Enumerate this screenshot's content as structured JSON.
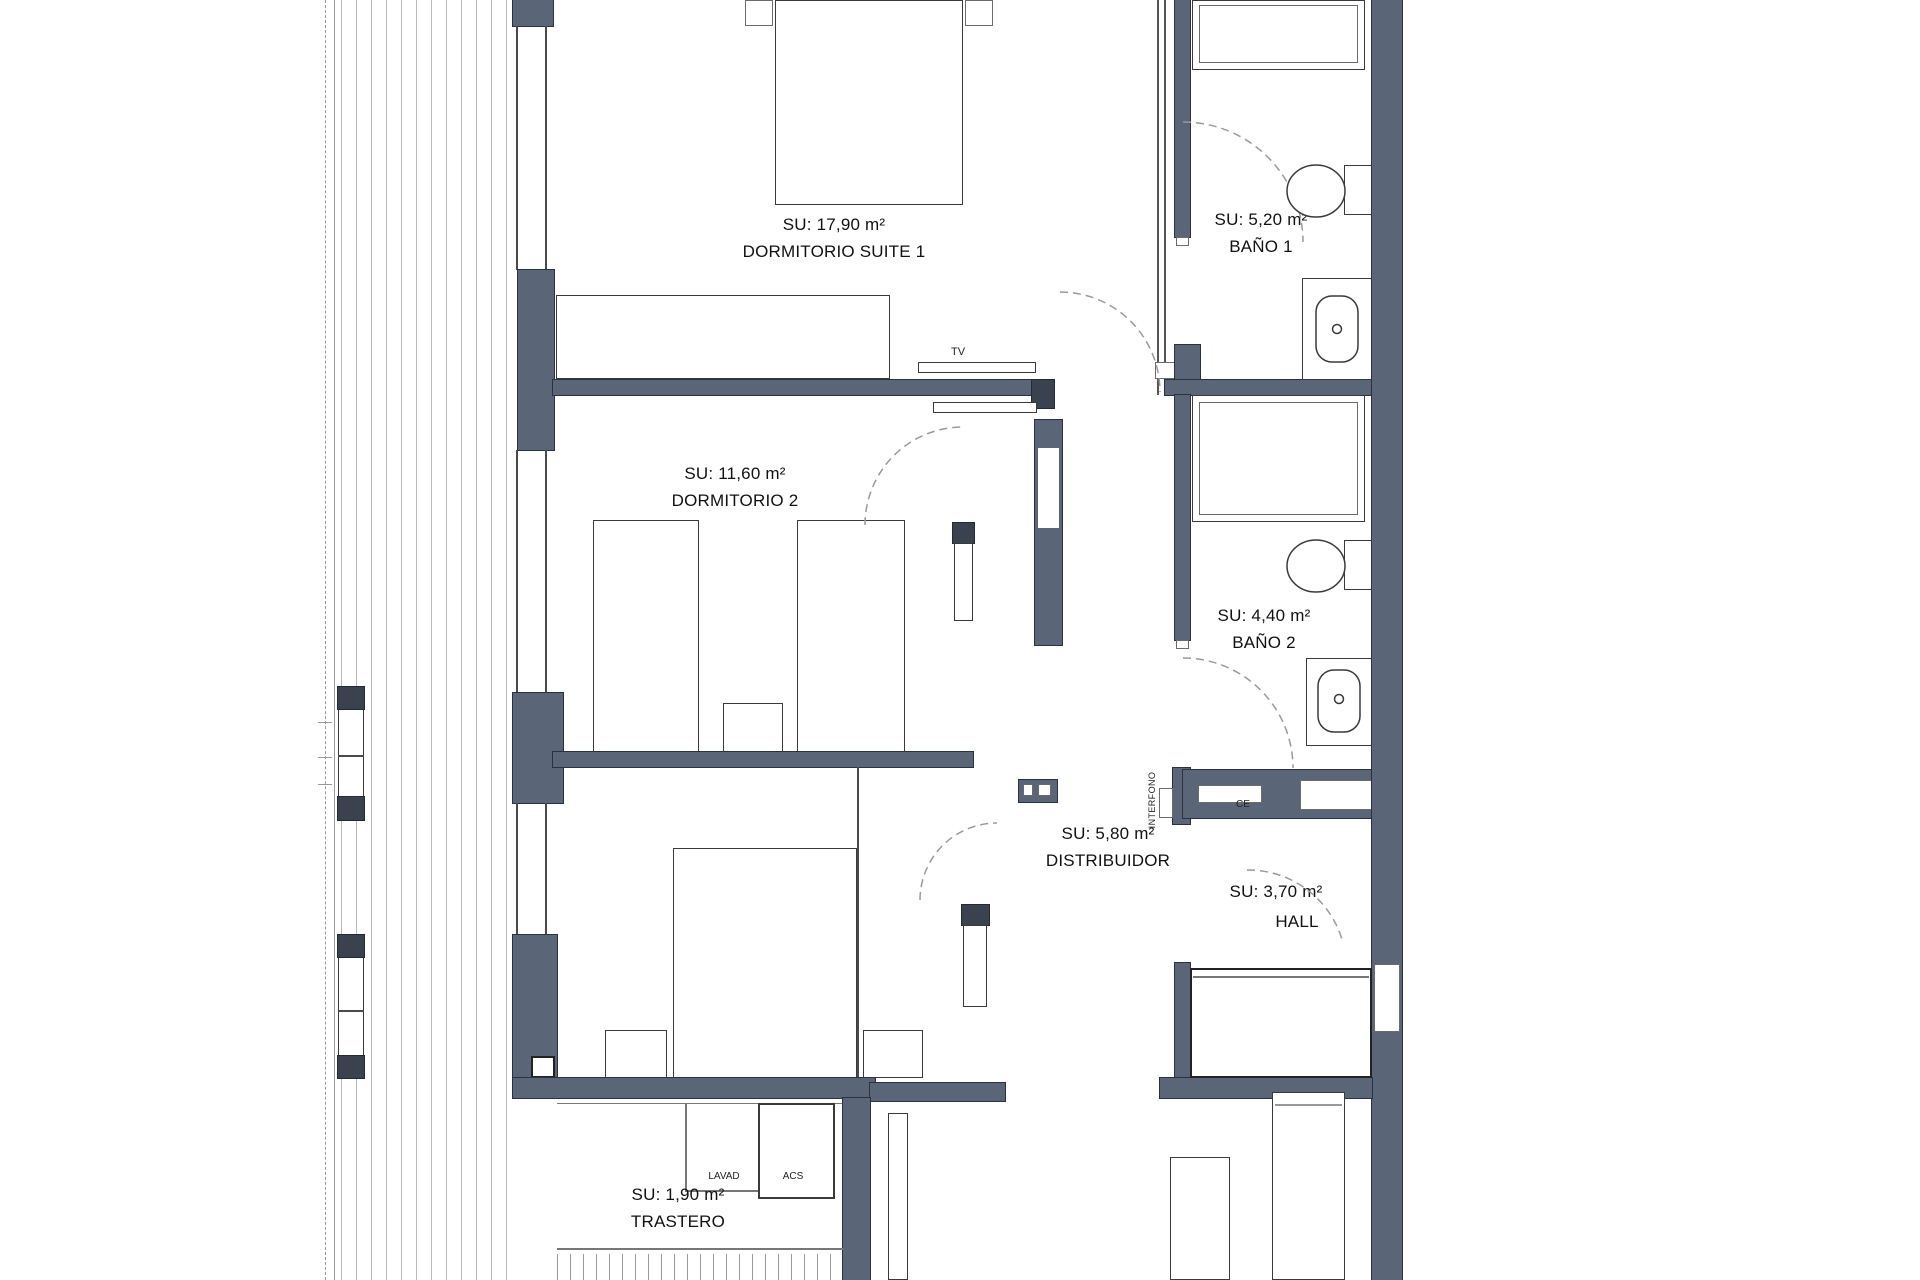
{
  "plan_type": "floor-plan",
  "colors": {
    "wall": "#5a6578",
    "wall_dark": "#39424e",
    "line": "#3a3a3a",
    "deck_line": "#b8b8b8",
    "arc": "#9a9a9a"
  },
  "rooms": {
    "suite1": {
      "area": "SU: 17,90 m²",
      "name": "DORMITORIO SUITE 1"
    },
    "dorm2": {
      "area": "SU: 11,60 m²",
      "name": "DORMITORIO 2"
    },
    "dorm3": {
      "area": "SU: 9,70 m²",
      "name": "DORMITORIO 3"
    },
    "bano1": {
      "area": "SU: 5,20 m²",
      "name": "BAÑO 1"
    },
    "bano2": {
      "area": "SU: 4,40 m²",
      "name": "BAÑO 2"
    },
    "distribuidor": {
      "area": "SU: 5,80 m²",
      "name": "DISTRIBUIDOR"
    },
    "hall": {
      "area": "SU: 3,70 m²",
      "name": "HALL"
    },
    "trastero": {
      "area": "SU: 1,90 m²",
      "name": "TRASTERO"
    }
  },
  "fixtures": {
    "tv": "TV",
    "lavad": "LAVAD",
    "acs": "ACS",
    "interfono": "INTERFONO",
    "ce": "CE"
  }
}
